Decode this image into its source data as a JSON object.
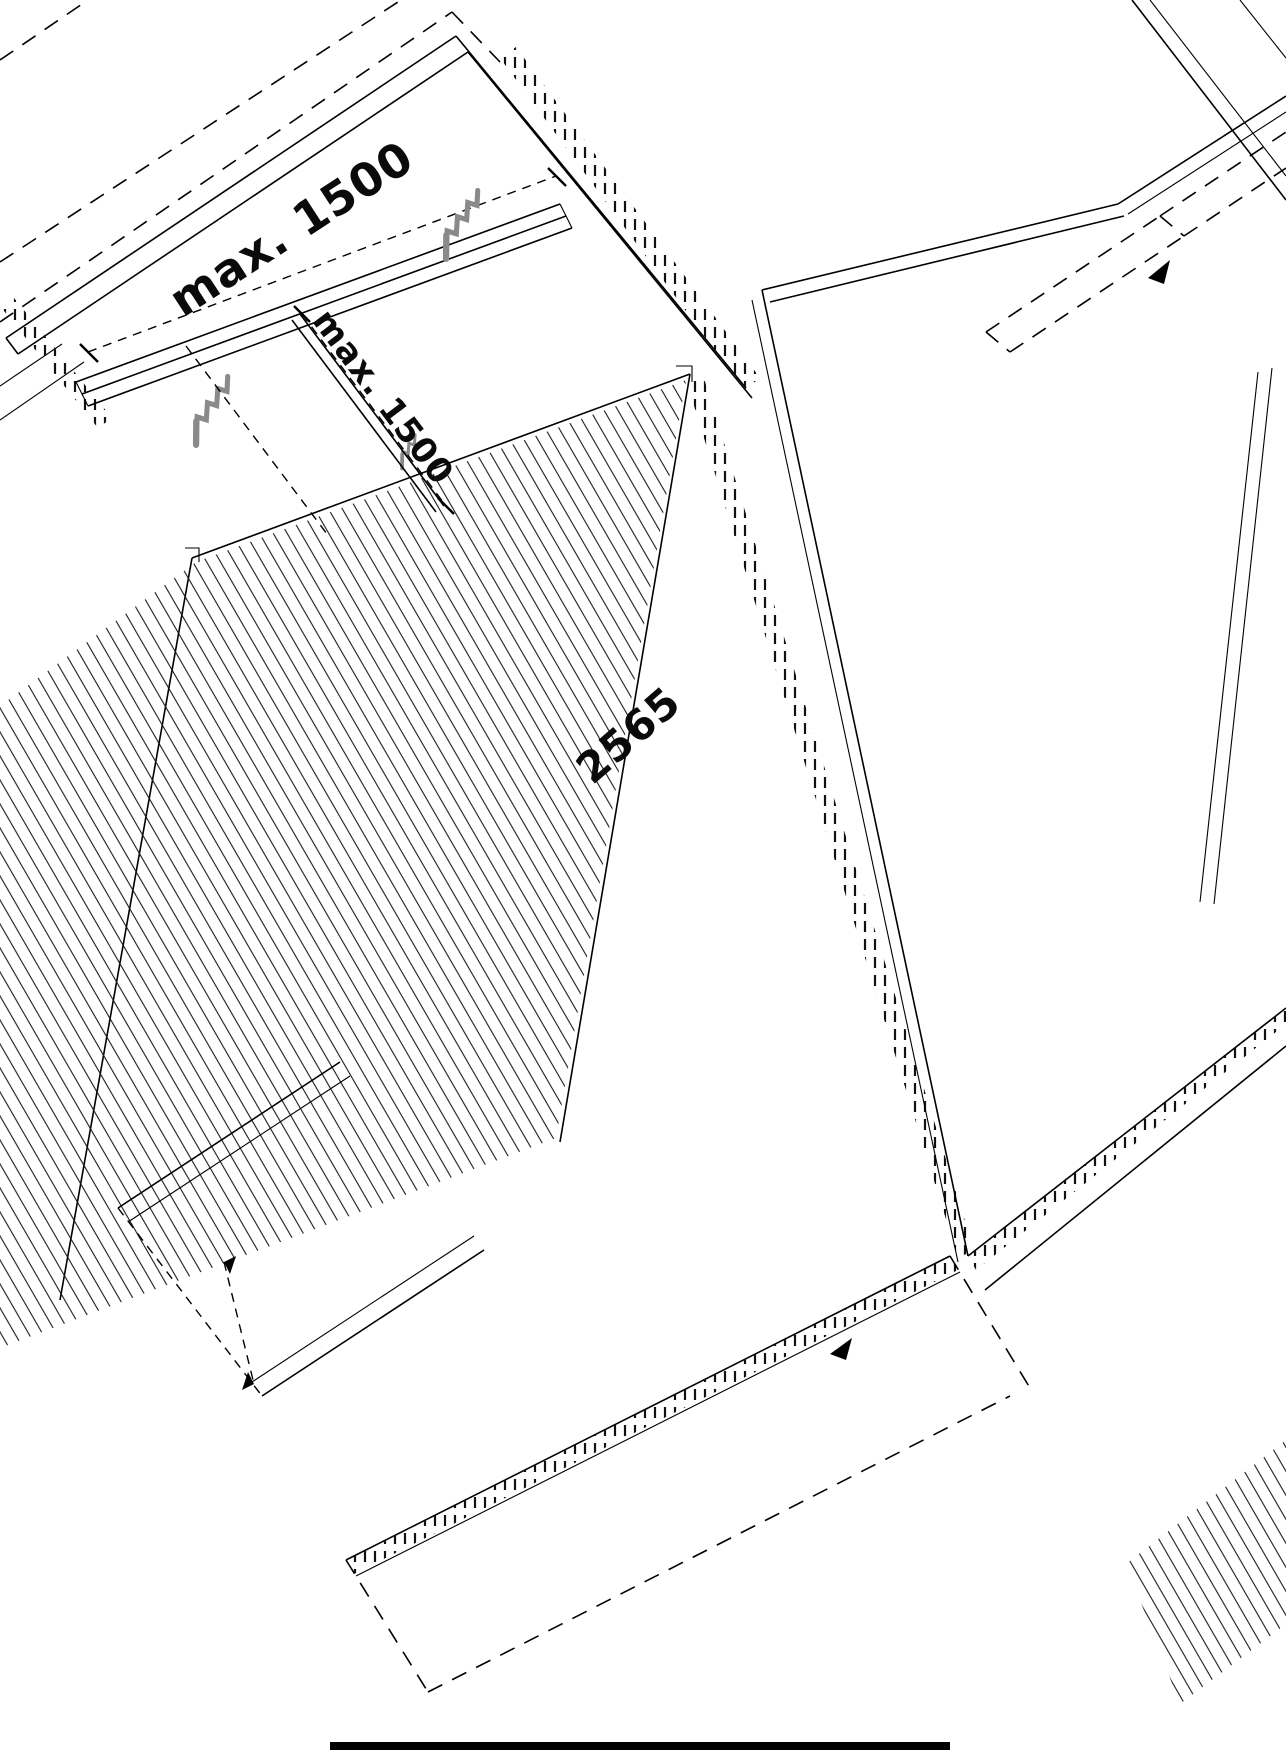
{
  "diagram": {
    "type": "isometric-assembly-drawing",
    "description_labels": {
      "dim_top_label": "max. 1500",
      "dim_mid_label": "max. 1500",
      "length_label": "2565"
    },
    "icons": {
      "screw": "screw-icon",
      "arrow": "direction-arrow-icon"
    },
    "colors": {
      "line": "#000000",
      "screw_gray": "#8a8a8a",
      "background": "#ffffff"
    }
  }
}
